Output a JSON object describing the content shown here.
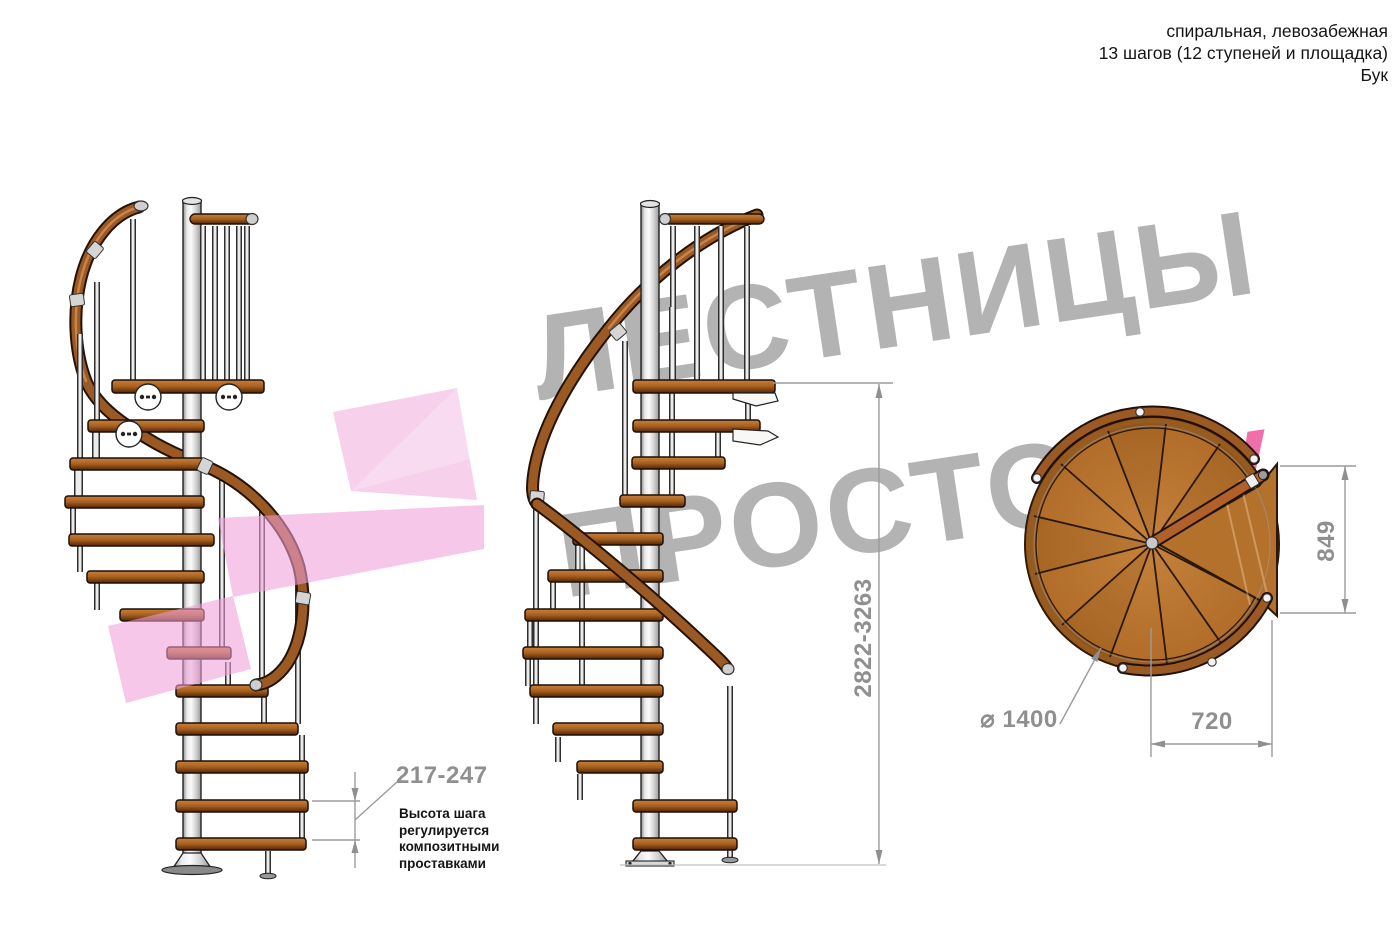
{
  "header": {
    "line1": "спиральная, левозабежная",
    "line2": "13 шагов (12 ступеней и площадка)",
    "line3": "Бук"
  },
  "watermark": {
    "line1": "ЛЕСТНИЦЫ",
    "line2_gray": "ПРОСТО",
    "line2_pink": ".Ру"
  },
  "annotations": {
    "step_height": "217-247",
    "step_height_note": [
      "Высота шага",
      "регулируется",
      "композитными",
      "проставками"
    ],
    "total_height": "2822-3263",
    "landing_side": "849",
    "landing_width": "720",
    "diameter": "⌀ 1400"
  },
  "colors": {
    "wood": "#a8601f",
    "handrail": "#9b5a24",
    "pole": "#d9d9d9",
    "dimension_gray": "#8f8f8f",
    "text_black": "#151515",
    "watermark_gray": "#b3b3b3",
    "watermark_pink": "#f06fab",
    "arrow_pink": "#ef9ed7"
  }
}
